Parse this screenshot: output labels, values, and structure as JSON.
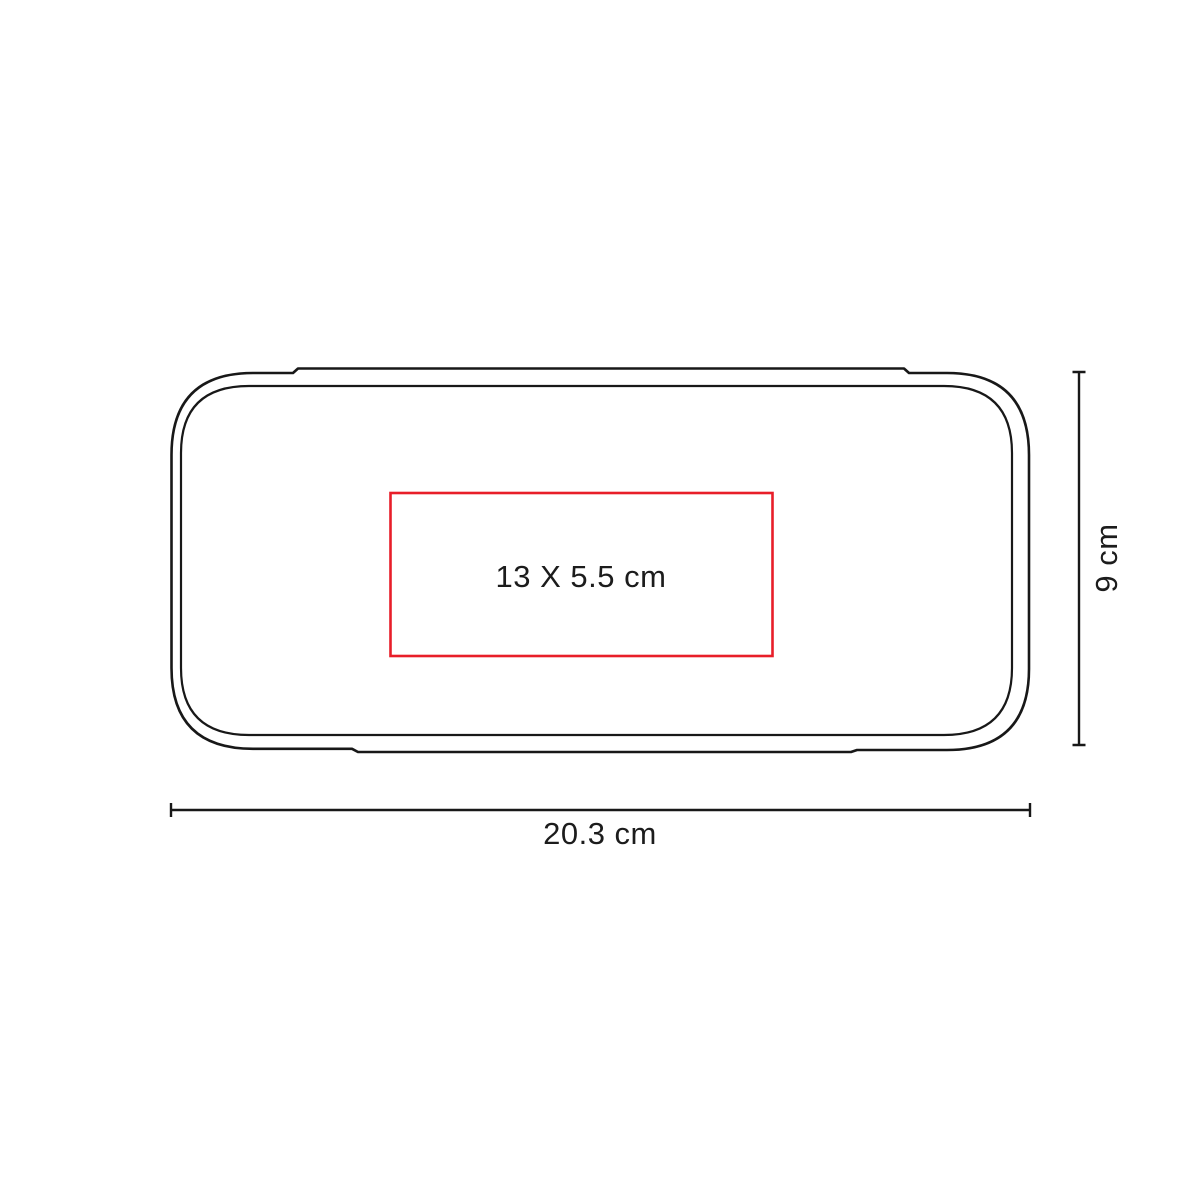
{
  "diagram": {
    "print_area": {
      "label": "13 X 5.5 cm"
    },
    "width_dimension": {
      "label": "20.3 cm"
    },
    "height_dimension": {
      "label": "9 cm"
    },
    "colors": {
      "outline": "#181818",
      "print_area_stroke": "#e81e29",
      "dimension_line": "#181818",
      "text": "#1c1c1c",
      "background": "#ffffff"
    }
  }
}
